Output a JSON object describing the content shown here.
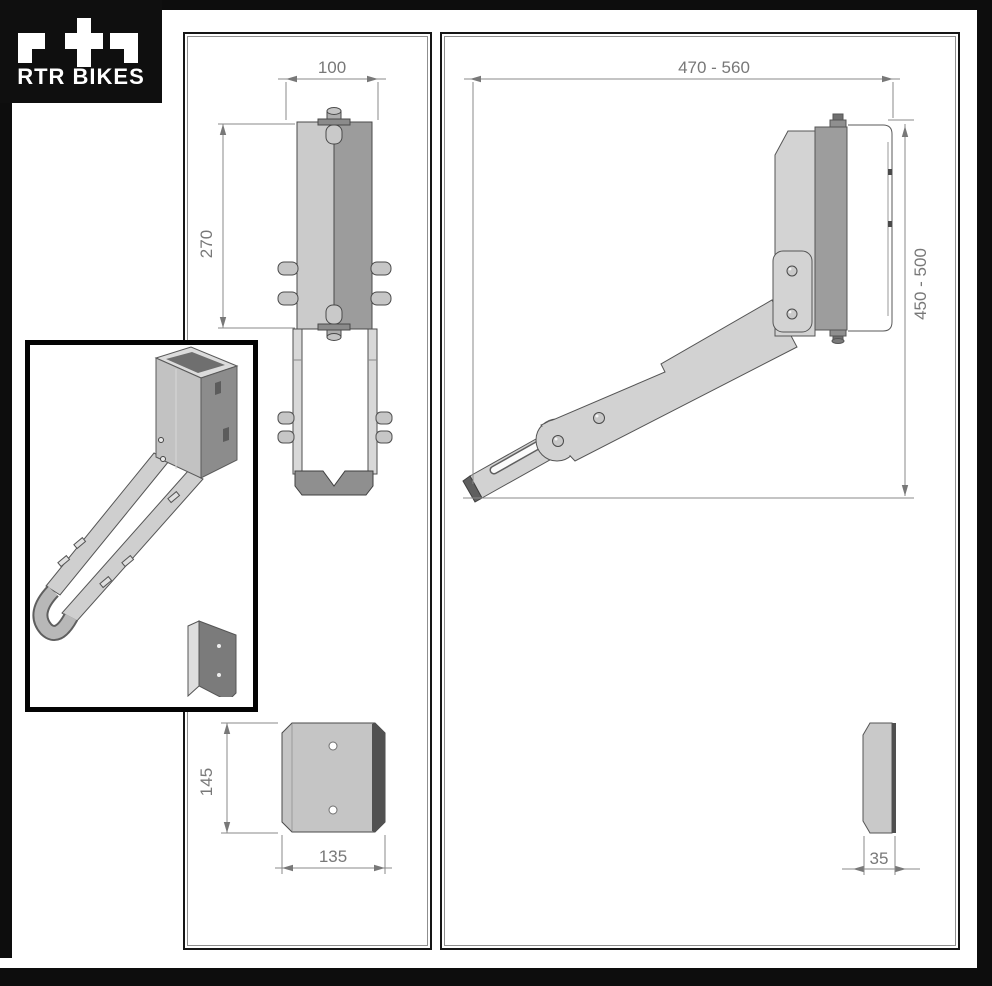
{
  "brand": {
    "name": "RTR BIKES"
  },
  "front_view": {
    "dim_width": "100",
    "dim_height": "270",
    "dim_plate_height": "145",
    "dim_plate_width": "135"
  },
  "side_view": {
    "dim_reach": "470 - 560",
    "dim_height": "450 - 500",
    "dim_plate_width": "35"
  },
  "colors": {
    "frame_black": "#0d0d0d",
    "dimension_gray": "#787878",
    "metal_light": "#d2d2d2",
    "metal_mid": "#9c9c9c",
    "metal_dark": "#4f4f4f",
    "background": "#ffffff"
  }
}
